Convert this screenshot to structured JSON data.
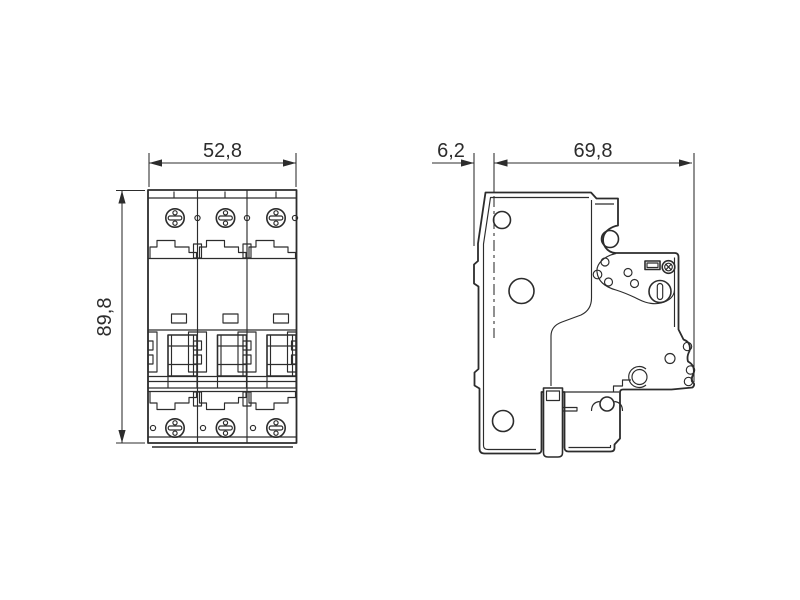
{
  "drawing": {
    "background": "#ffffff",
    "line_color": "#2c2c2c",
    "views": {
      "front": {
        "width_dim": "52,8",
        "height_dim": "89,8"
      },
      "side": {
        "front_offset_dim": "6,2",
        "depth_dim": "69,8"
      }
    },
    "icons": {
      "screw_head": "phillips-screw-head",
      "slotted_screw": "slotted-screw-head",
      "knurled_screw": "knurled-adjustment-screw",
      "din_clip": "din-rail-clip-slider",
      "centerline": "dash-dot-reference-line"
    }
  }
}
